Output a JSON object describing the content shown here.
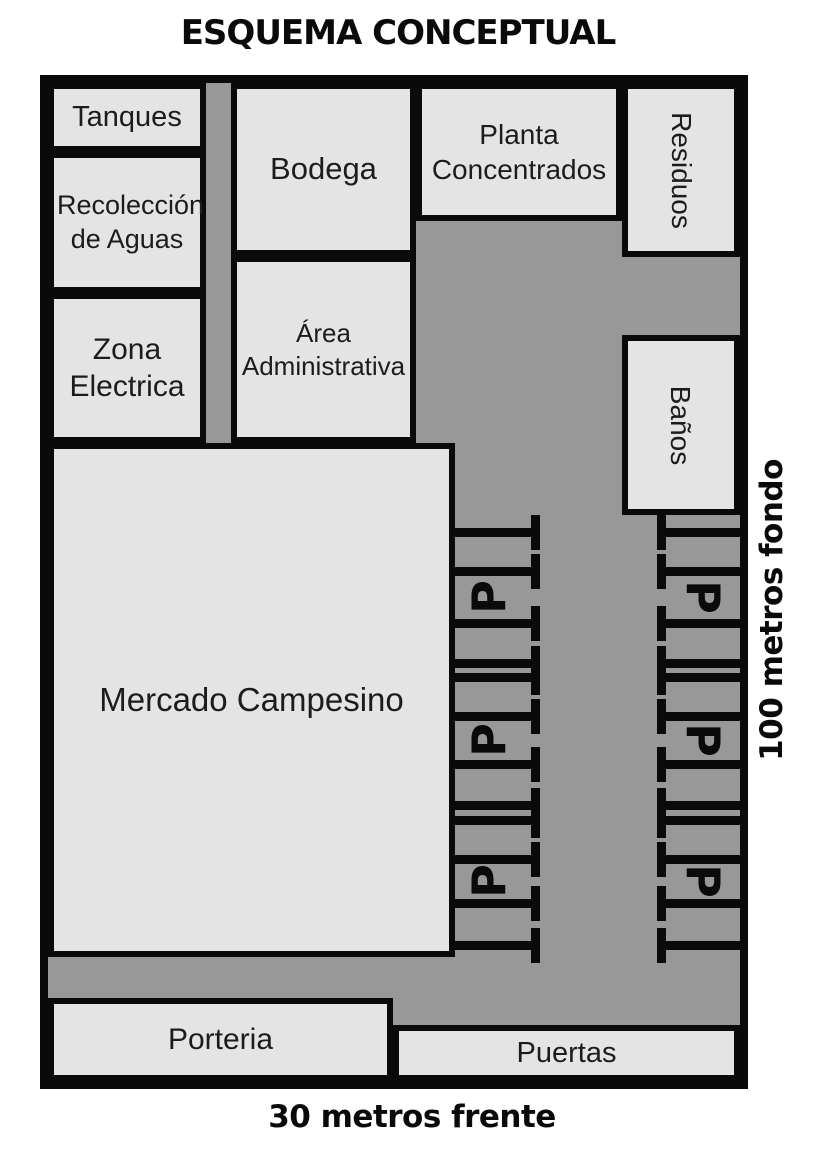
{
  "title": "ESQUEMA CONCEPTUAL",
  "dimensions": {
    "depth_label": "100 metros fondo",
    "front_label": "30 metros frente"
  },
  "rooms": {
    "tanques": "Tanques",
    "recoleccion": "Recolección de Aguas",
    "zona_electrica": "Zona Electrica",
    "bodega": "Bodega",
    "area_administrativa": "Área Administrativa",
    "planta_concentrados": "Planta Concentrados",
    "residuos": "Residuos",
    "banos": "Baños",
    "mercado": "Mercado Campesino",
    "porteria": "Porteria",
    "puertas": "Puertas"
  },
  "parking": {
    "p_label": "P",
    "left_column_groups": 3,
    "right_column_groups": 3,
    "stalls_per_group": 3
  },
  "colors": {
    "room_fill": "#e4e4e4",
    "road": "#989898",
    "line": "#0a0a0a",
    "background": "#ffffff"
  }
}
